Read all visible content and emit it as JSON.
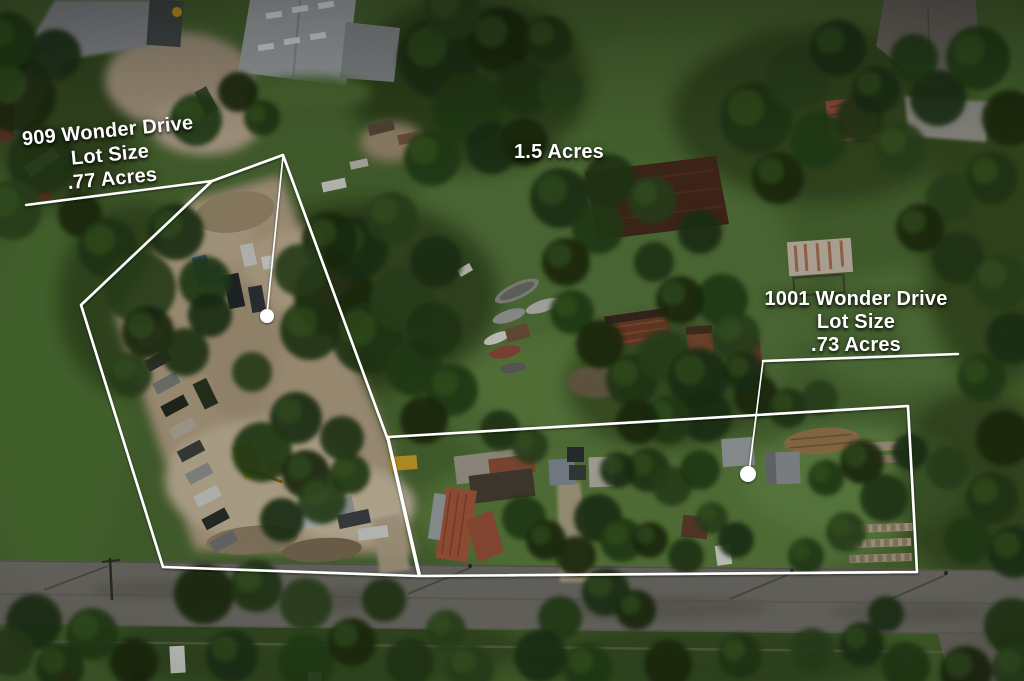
{
  "annotations": {
    "lot909": {
      "address": "909 Wonder Drive",
      "lot_size_label": "Lot Size",
      "acreage": ".77 Acres"
    },
    "field": {
      "acreage": "1.5 Acres"
    },
    "lot1001": {
      "address": "1001 Wonder Drive",
      "lot_size_label": "Lot Size",
      "acreage": ".73 Acres"
    }
  },
  "colors": {
    "boundary": "#ffffff",
    "marker_dot": "#ffffff",
    "label_text": "#ffffff",
    "grass_base": "#4a6832",
    "grass_light": "#5d8040",
    "canopy_dark": "#1c2f12",
    "dirt": "#b09e82",
    "road": "#716f68",
    "warehouse_roof": "#a6abae",
    "barn_roof": "#46291b",
    "rust_roof": "#a3583c"
  }
}
